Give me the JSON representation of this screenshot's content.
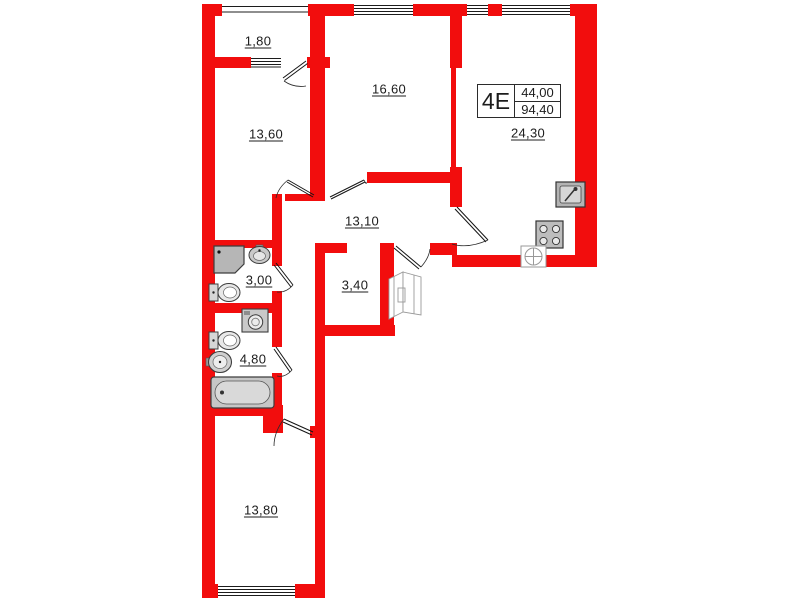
{
  "plan": {
    "unit_type": "4Е",
    "living_area": "44,00",
    "total_area": "94,40"
  },
  "rooms": {
    "balcony": "1,80",
    "room1": "13,60",
    "room2": "16,60",
    "kitchen_living": "24,30",
    "hall": "13,10",
    "bathroom1": "3,00",
    "storage": "3,40",
    "bathroom2": "4,80",
    "room3": "13,80"
  },
  "icons": [
    "shower-icon",
    "washbasin-icon",
    "toilet-icon",
    "washing-machine-icon",
    "round-sink-icon",
    "bathtub-icon",
    "wardrobe-icon",
    "kitchen-sink-icon",
    "stove-icon",
    "vent-icon"
  ],
  "colors": {
    "wall": "#f20d0d",
    "fixture_fill": "#c4c4c4",
    "line": "#1c1c1c"
  }
}
